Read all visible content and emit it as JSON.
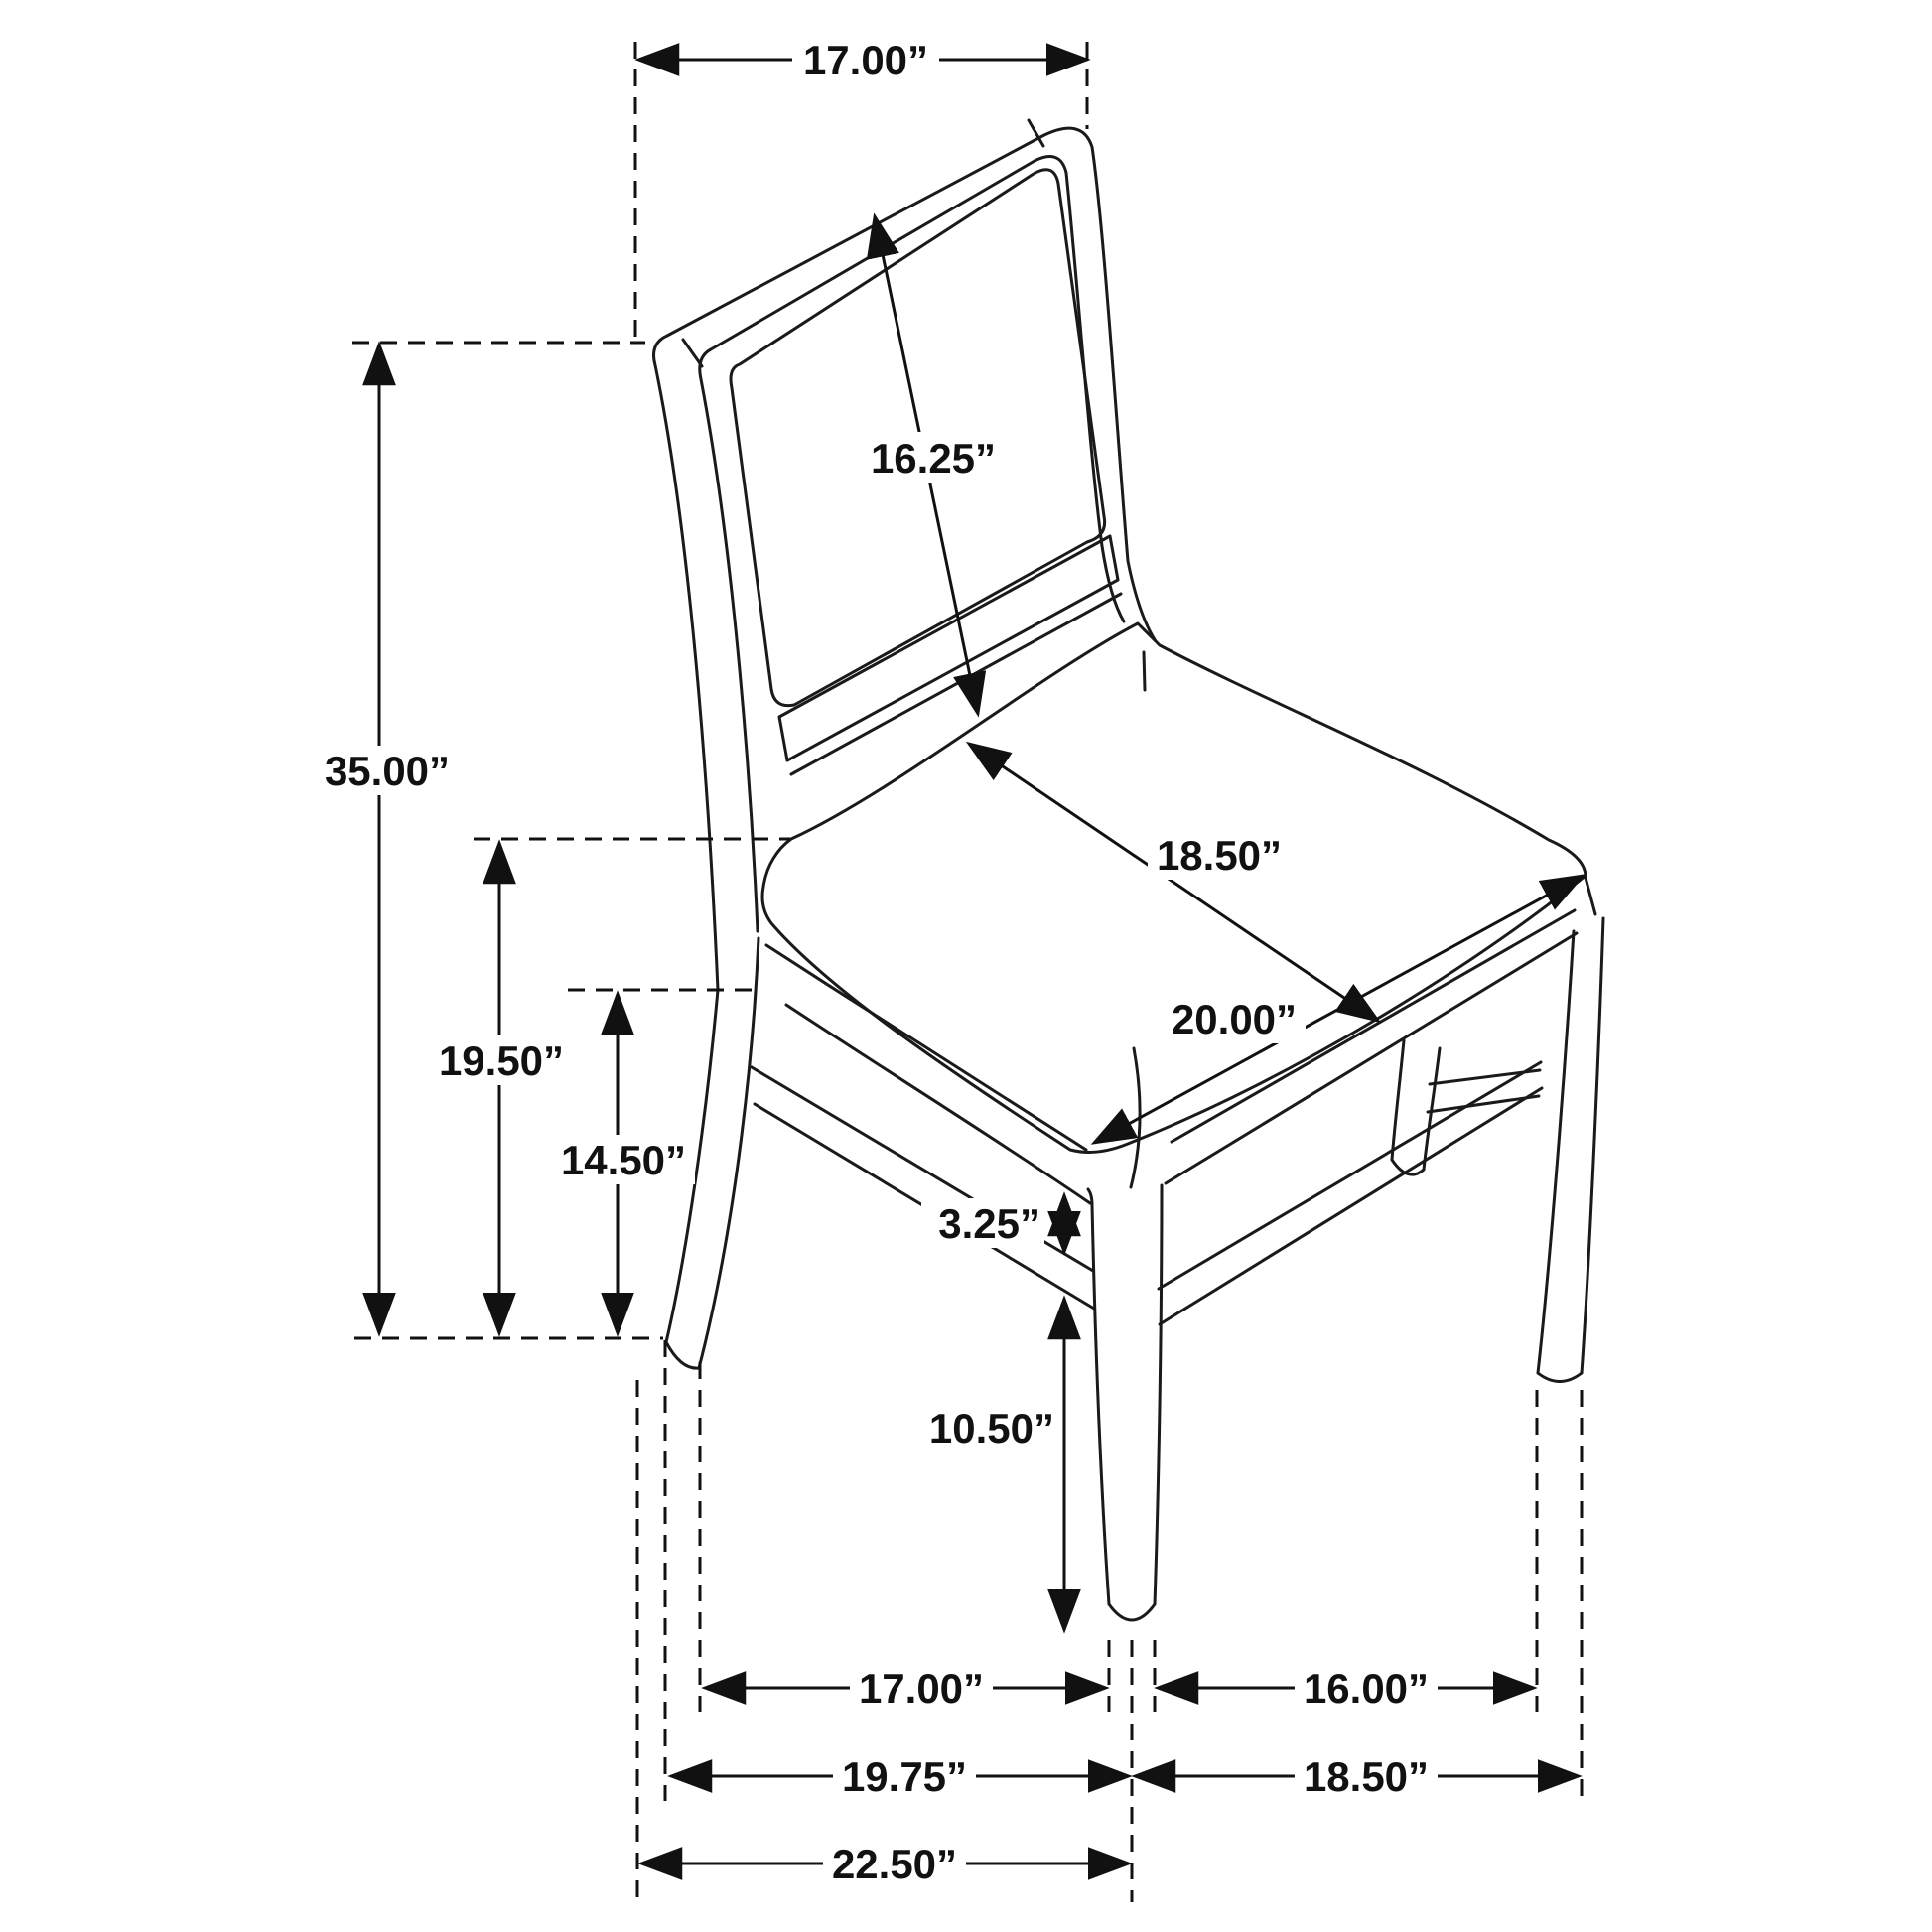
{
  "colors": {
    "ink": "#111111",
    "line_art": "#1a1a1a",
    "background": "#ffffff"
  },
  "dims": {
    "back_width": "17.00”",
    "overall_height": "35.00”",
    "back_panel_length": "16.25”",
    "seat_depth": "18.50”",
    "seat_width": "20.00”",
    "seat_height": "19.50”",
    "stretcher_height": "14.50”",
    "rail_stretcher_gap": "3.25”",
    "leg_height": "10.50”",
    "front_leg_spacing": "17.00”",
    "side_leg_spacing": "16.00”",
    "footprint_depth_left": "19.75”",
    "footprint_depth_right": "18.50”",
    "overall_depth": "22.50”"
  }
}
